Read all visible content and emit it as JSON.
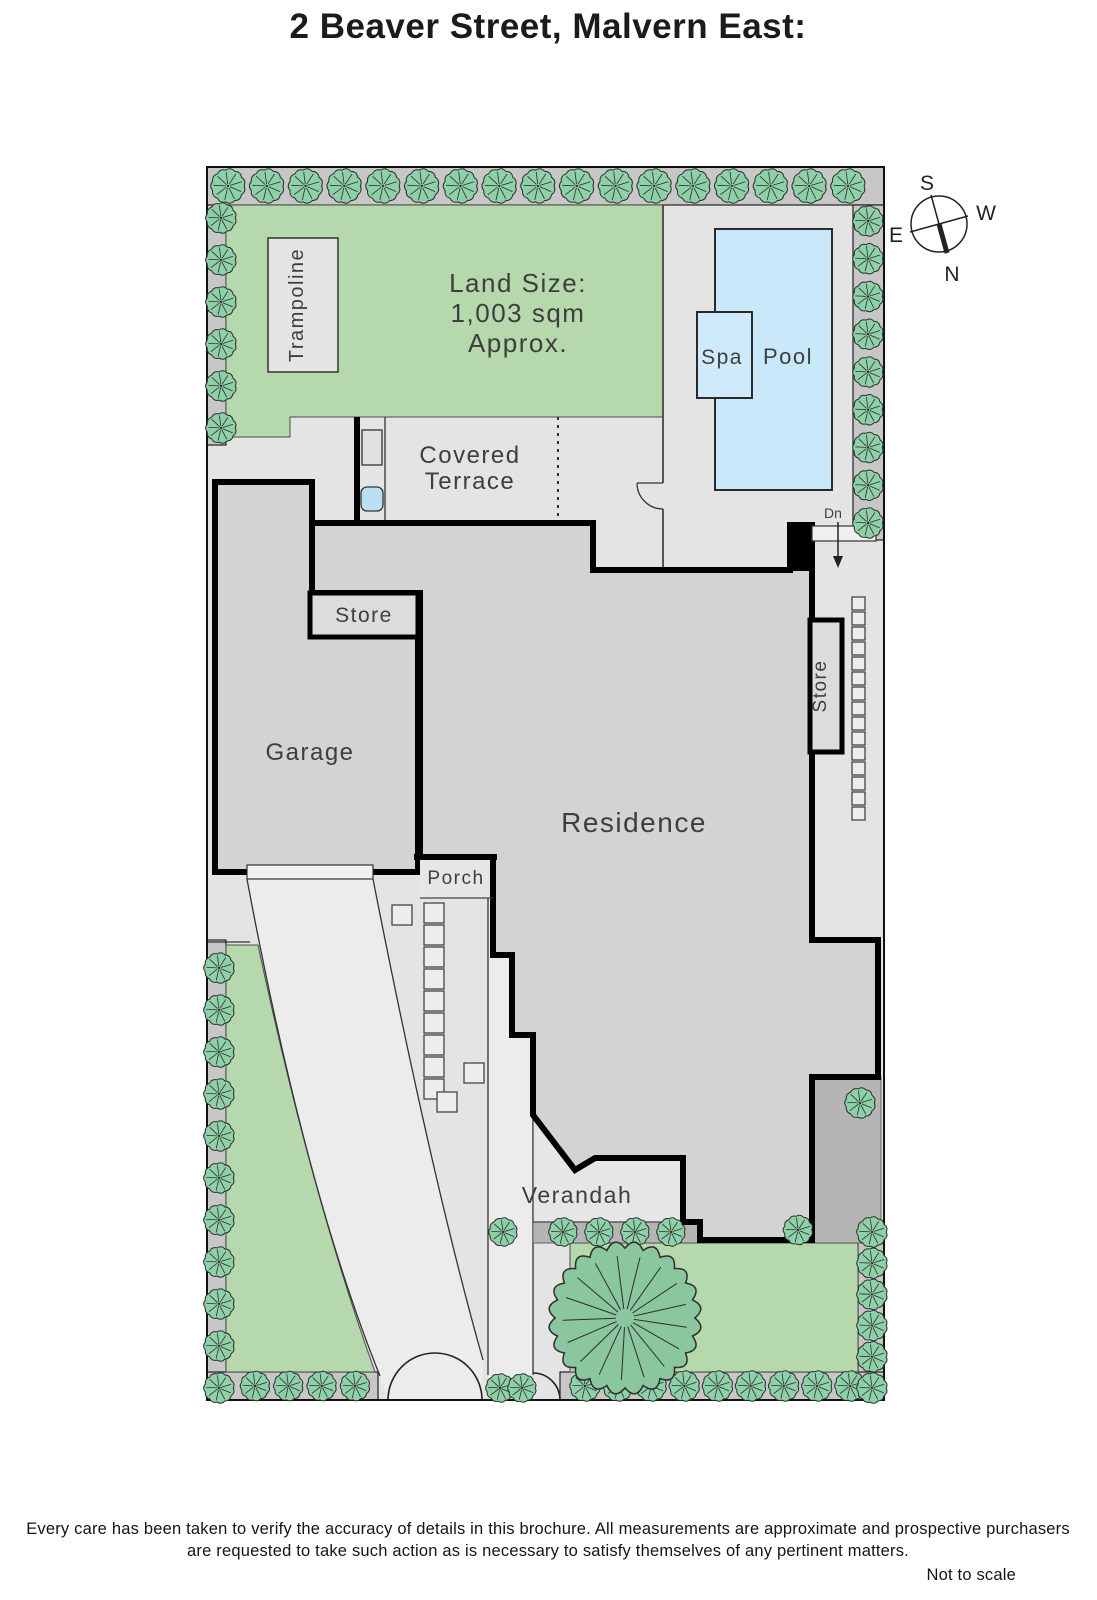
{
  "title": "2 Beaver Street, Malvern East:",
  "compass": {
    "n": "N",
    "s": "S",
    "e": "E",
    "w": "W"
  },
  "labels": {
    "trampoline": "Trampoline",
    "land_size1": "Land Size:",
    "land_size2": "1,003 sqm",
    "land_size3": "Approx.",
    "covered1": "Covered",
    "covered2": "Terrace",
    "spa": "Spa",
    "pool": "Pool",
    "store_left": "Store",
    "store_right": "Store",
    "garage": "Garage",
    "residence": "Residence",
    "porch": "Porch",
    "verandah": "Verandah",
    "dn": "Dn"
  },
  "footer": {
    "line1": "Every care has been taken to verify the accuracy of details in this brochure.  All measurements are approximate and prospective purchasers",
    "line2": "are requested to take such action as is necessary to satisfy themselves of any pertinent matters.",
    "note": "Not to scale"
  },
  "colors": {
    "lawn_green": "#b5d9ad",
    "tree_fill": "#8ed0a7",
    "tree_stroke": "#2e2e2e",
    "big_tree_fill": "#8ac69e",
    "boundary_strip_gray": "#c7c7c7",
    "paving_gray": "#e4e4e4",
    "drive_gray": "#ececec",
    "building_gray": "#d3d3d3",
    "dark_patch_gray": "#b5b5b5",
    "pool_blue": "#c9e9fa",
    "spa_blue": "#cfeafa",
    "wall_black": "#000000",
    "stone_fill": "#ededed",
    "stone_stroke": "#444444"
  },
  "plan": {
    "tree_strips": [
      {
        "orient": "h",
        "fixed": 186,
        "start": 228,
        "end": 848,
        "count": 17,
        "r": 17.5
      },
      {
        "orient": "v",
        "fixed": 868,
        "start": 221,
        "end": 523,
        "count": 9,
        "r": 15.5
      },
      {
        "orient": "v",
        "fixed": 221,
        "start": 218,
        "end": 428,
        "count": 6,
        "r": 15.5
      },
      {
        "orient": "v",
        "fixed": 219,
        "start": 968,
        "end": 1388,
        "count": 11,
        "r": 15.5
      },
      {
        "orient": "h",
        "fixed": 1386,
        "start": 255,
        "end": 355,
        "count": 4,
        "r": 15
      },
      {
        "orient": "h",
        "fixed": 1232,
        "start": 563,
        "end": 671,
        "count": 4,
        "r": 14.5
      },
      {
        "orient": "h",
        "fixed": 1386,
        "start": 585,
        "end": 850,
        "count": 9,
        "r": 15.5
      },
      {
        "orient": "v",
        "fixed": 872,
        "start": 1232,
        "end": 1388,
        "count": 6,
        "r": 15.5
      }
    ],
    "single_trees": [
      [
        503,
        1232,
        14.5
      ],
      [
        798,
        1230,
        15
      ],
      [
        860,
        1103,
        15.5
      ],
      [
        500,
        1388,
        14.5
      ],
      [
        522,
        1388,
        14.5
      ]
    ],
    "big_tree": {
      "x": 625,
      "y": 1318,
      "r": 76
    },
    "stepping_stones": {
      "columns": [
        {
          "x": 424,
          "y": 903,
          "count": 9,
          "step": 22,
          "size": 20
        },
        {
          "x": 852,
          "y": 597,
          "count": 15,
          "step": 15,
          "size": 13
        }
      ],
      "singles": [
        [
          392,
          905,
          20
        ],
        [
          464,
          1063,
          20
        ],
        [
          437,
          1092,
          20
        ]
      ]
    }
  }
}
